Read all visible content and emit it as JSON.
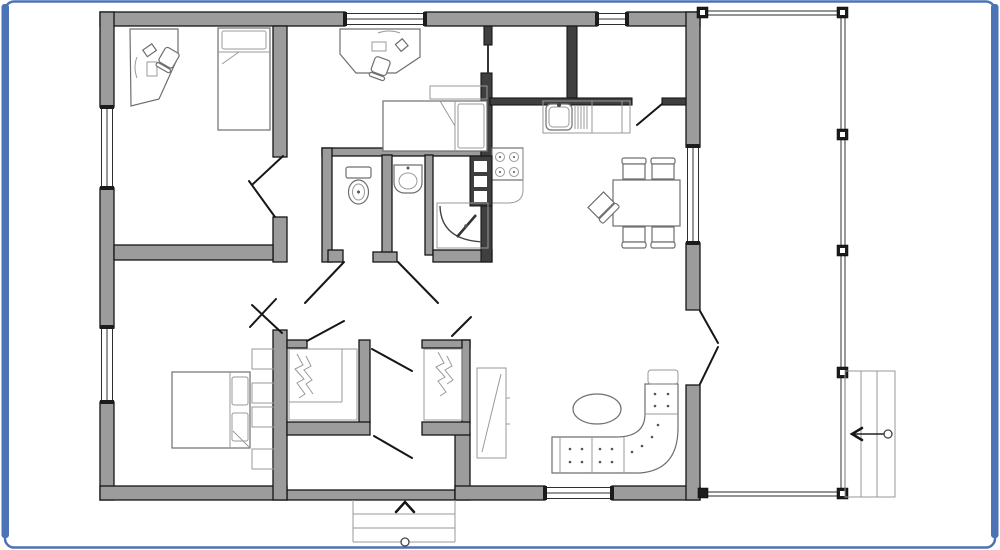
{
  "meta": {
    "type": "architectural-floor-plan",
    "description": "Single-storey house floor plan with side porch, deck stairs and entry steps",
    "visible_text": []
  },
  "palette": {
    "frame": "#4b73b5",
    "background": "#ffffff",
    "wall_fill": "#9c9c9c",
    "wall_dark": "#3f3f3f",
    "outline": "#161616",
    "furniture_stroke": "#6f6f6f",
    "light_stroke": "#9a9a9a",
    "door_stroke": "#161616",
    "window_stroke": "#2f2f2f",
    "porch_stroke": "#555555"
  },
  "rooms": [
    {
      "name": "office-bedroom-top-left",
      "furniture": [
        "corner-desk",
        "desk-chair",
        "computer",
        "single-bed"
      ]
    },
    {
      "name": "bedroom-top-middle",
      "furniture": [
        "desk",
        "desk-chair",
        "single-bed",
        "shelf"
      ]
    },
    {
      "name": "kitchen",
      "furniture": [
        "double-sink",
        "drainboard",
        "dishwasher",
        "cooktop-4-burner",
        "oven-tower"
      ]
    },
    {
      "name": "dining-area",
      "furniture": [
        "dining-table",
        "chairs-x5"
      ]
    },
    {
      "name": "bathroom-wc",
      "furniture": [
        "toilet"
      ]
    },
    {
      "name": "bathroom-washroom",
      "furniture": [
        "washbasin",
        "shower-cabin"
      ]
    },
    {
      "name": "bedroom-bottom-left",
      "furniture": [
        "double-bed",
        "wardrobe-shelves"
      ]
    },
    {
      "name": "closet-left",
      "furniture": [
        "hanging-rail"
      ]
    },
    {
      "name": "closet-right",
      "furniture": [
        "hanging-rail"
      ]
    },
    {
      "name": "entry-hall",
      "furniture": [
        "mirror-cabinet"
      ]
    },
    {
      "name": "living-room",
      "furniture": [
        "corner-sofa",
        "oval-coffee-table"
      ]
    },
    {
      "name": "porch-deck",
      "furniture": [
        "posts",
        "deck-stairs"
      ]
    }
  ],
  "features": {
    "window_count": 6,
    "door_swing_count": 13,
    "porch_post_count": 7,
    "deck_stairs": {
      "location": "bottom-right",
      "direction_arrow": "left",
      "start_marker": "circle"
    },
    "entry_steps": {
      "location": "bottom-center",
      "direction_arrow": "up",
      "start_marker": "circle"
    },
    "french_doors_to_porch": true
  }
}
